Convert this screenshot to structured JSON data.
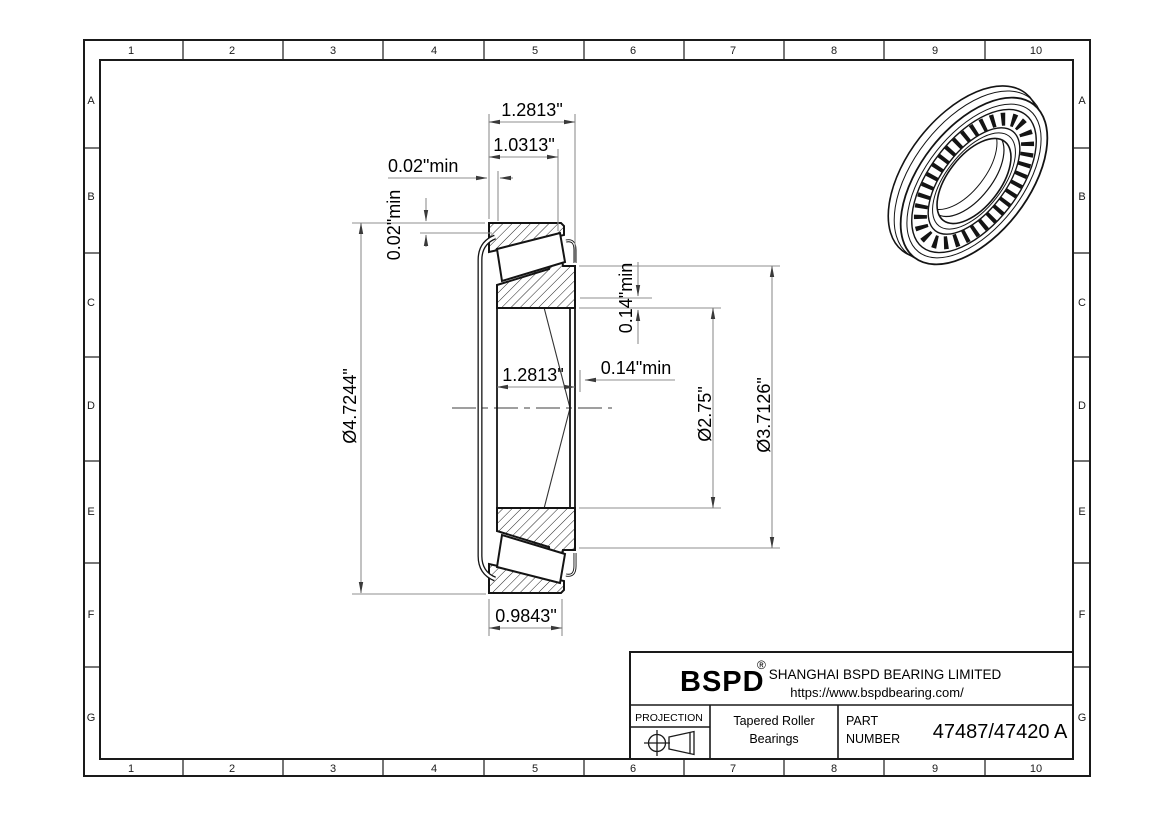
{
  "grid": {
    "cols": [
      "1",
      "2",
      "3",
      "4",
      "5",
      "6",
      "7",
      "8",
      "9",
      "10"
    ],
    "rows": [
      "A",
      "B",
      "C",
      "D",
      "E",
      "F",
      "G"
    ]
  },
  "dimensions": {
    "overall_width": "1.2813\"",
    "cone_width": "1.0313\"",
    "cage_clearance_axial": "0.02\"min",
    "cage_clearance_radial": "0.02\"min",
    "outer_diameter": "Ø4.7244\"",
    "housing_shoulder_diameter": "Ø3.7126\"",
    "bore_diameter": "Ø2.75\"",
    "backing_shoulder_radial": "0.14\"min",
    "backing_shoulder_axial": "0.14\"min",
    "inner_width": "1.2813\"",
    "cup_width": "0.9843\""
  },
  "title_block": {
    "brand": "BSPD",
    "registered_mark": "®",
    "company": "SHANGHAI BSPD BEARING LIMITED",
    "url": "https://www.bspdbearing.com/",
    "projection_label": "PROJECTION",
    "product_line1": "Tapered Roller",
    "product_line2": "Bearings",
    "part_label_line1": "PART",
    "part_label_line2": "NUMBER",
    "part_number": "47487/47420 A"
  },
  "colors": {
    "line": "#141414",
    "dim_line": "#8f8f8f",
    "background": "#ffffff"
  }
}
